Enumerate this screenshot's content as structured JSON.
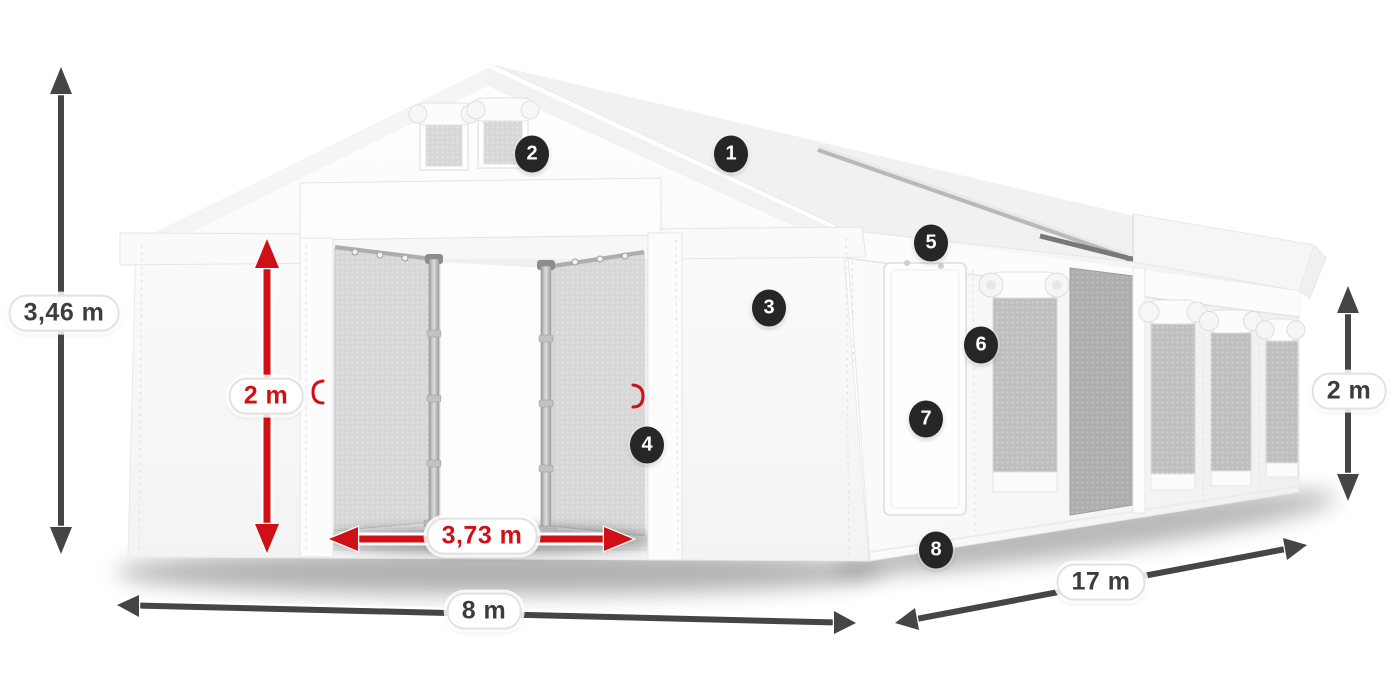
{
  "dimensions": {
    "total_height": "3,46 m",
    "door_height": "2 m",
    "door_width": "3,73 m",
    "front_width": "8 m",
    "length": "17 m",
    "side_wall_height": "2 m"
  },
  "markers": [
    {
      "label": "1"
    },
    {
      "label": "2"
    },
    {
      "label": "3"
    },
    {
      "label": "4"
    },
    {
      "label": "5"
    },
    {
      "label": "6"
    },
    {
      "label": "7"
    },
    {
      "label": "8"
    }
  ],
  "colors": {
    "accent_red": "#cf1016",
    "dim_dark": "#454545",
    "badge_bg": "#262626",
    "label_text": "#3d3d3d"
  }
}
